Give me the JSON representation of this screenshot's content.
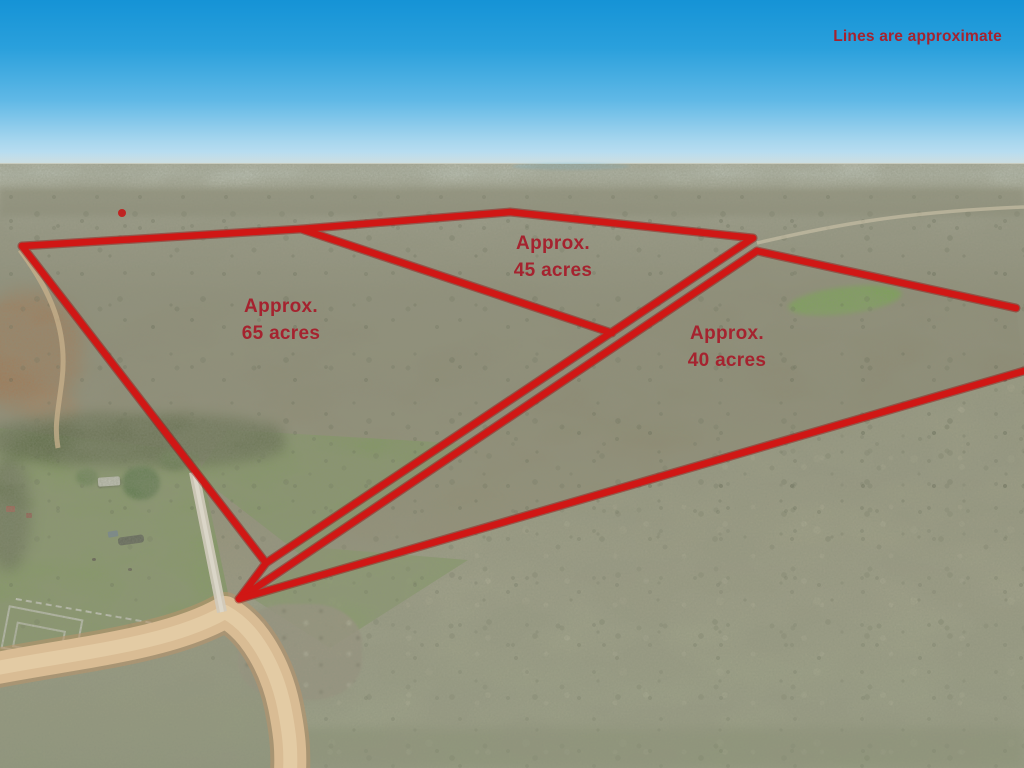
{
  "overlay": {
    "disclaimer": "Lines are approximate",
    "parcels": [
      {
        "acres": 65,
        "line1": "Approx.",
        "line2": "65 acres"
      },
      {
        "acres": 45,
        "line1": "Approx.",
        "line2": "45 acres"
      },
      {
        "acres": 40,
        "line1": "Approx.",
        "line2": "40 acres"
      }
    ],
    "colors": {
      "boundary_line": "#d01715",
      "label_text": "#a5232f"
    }
  }
}
